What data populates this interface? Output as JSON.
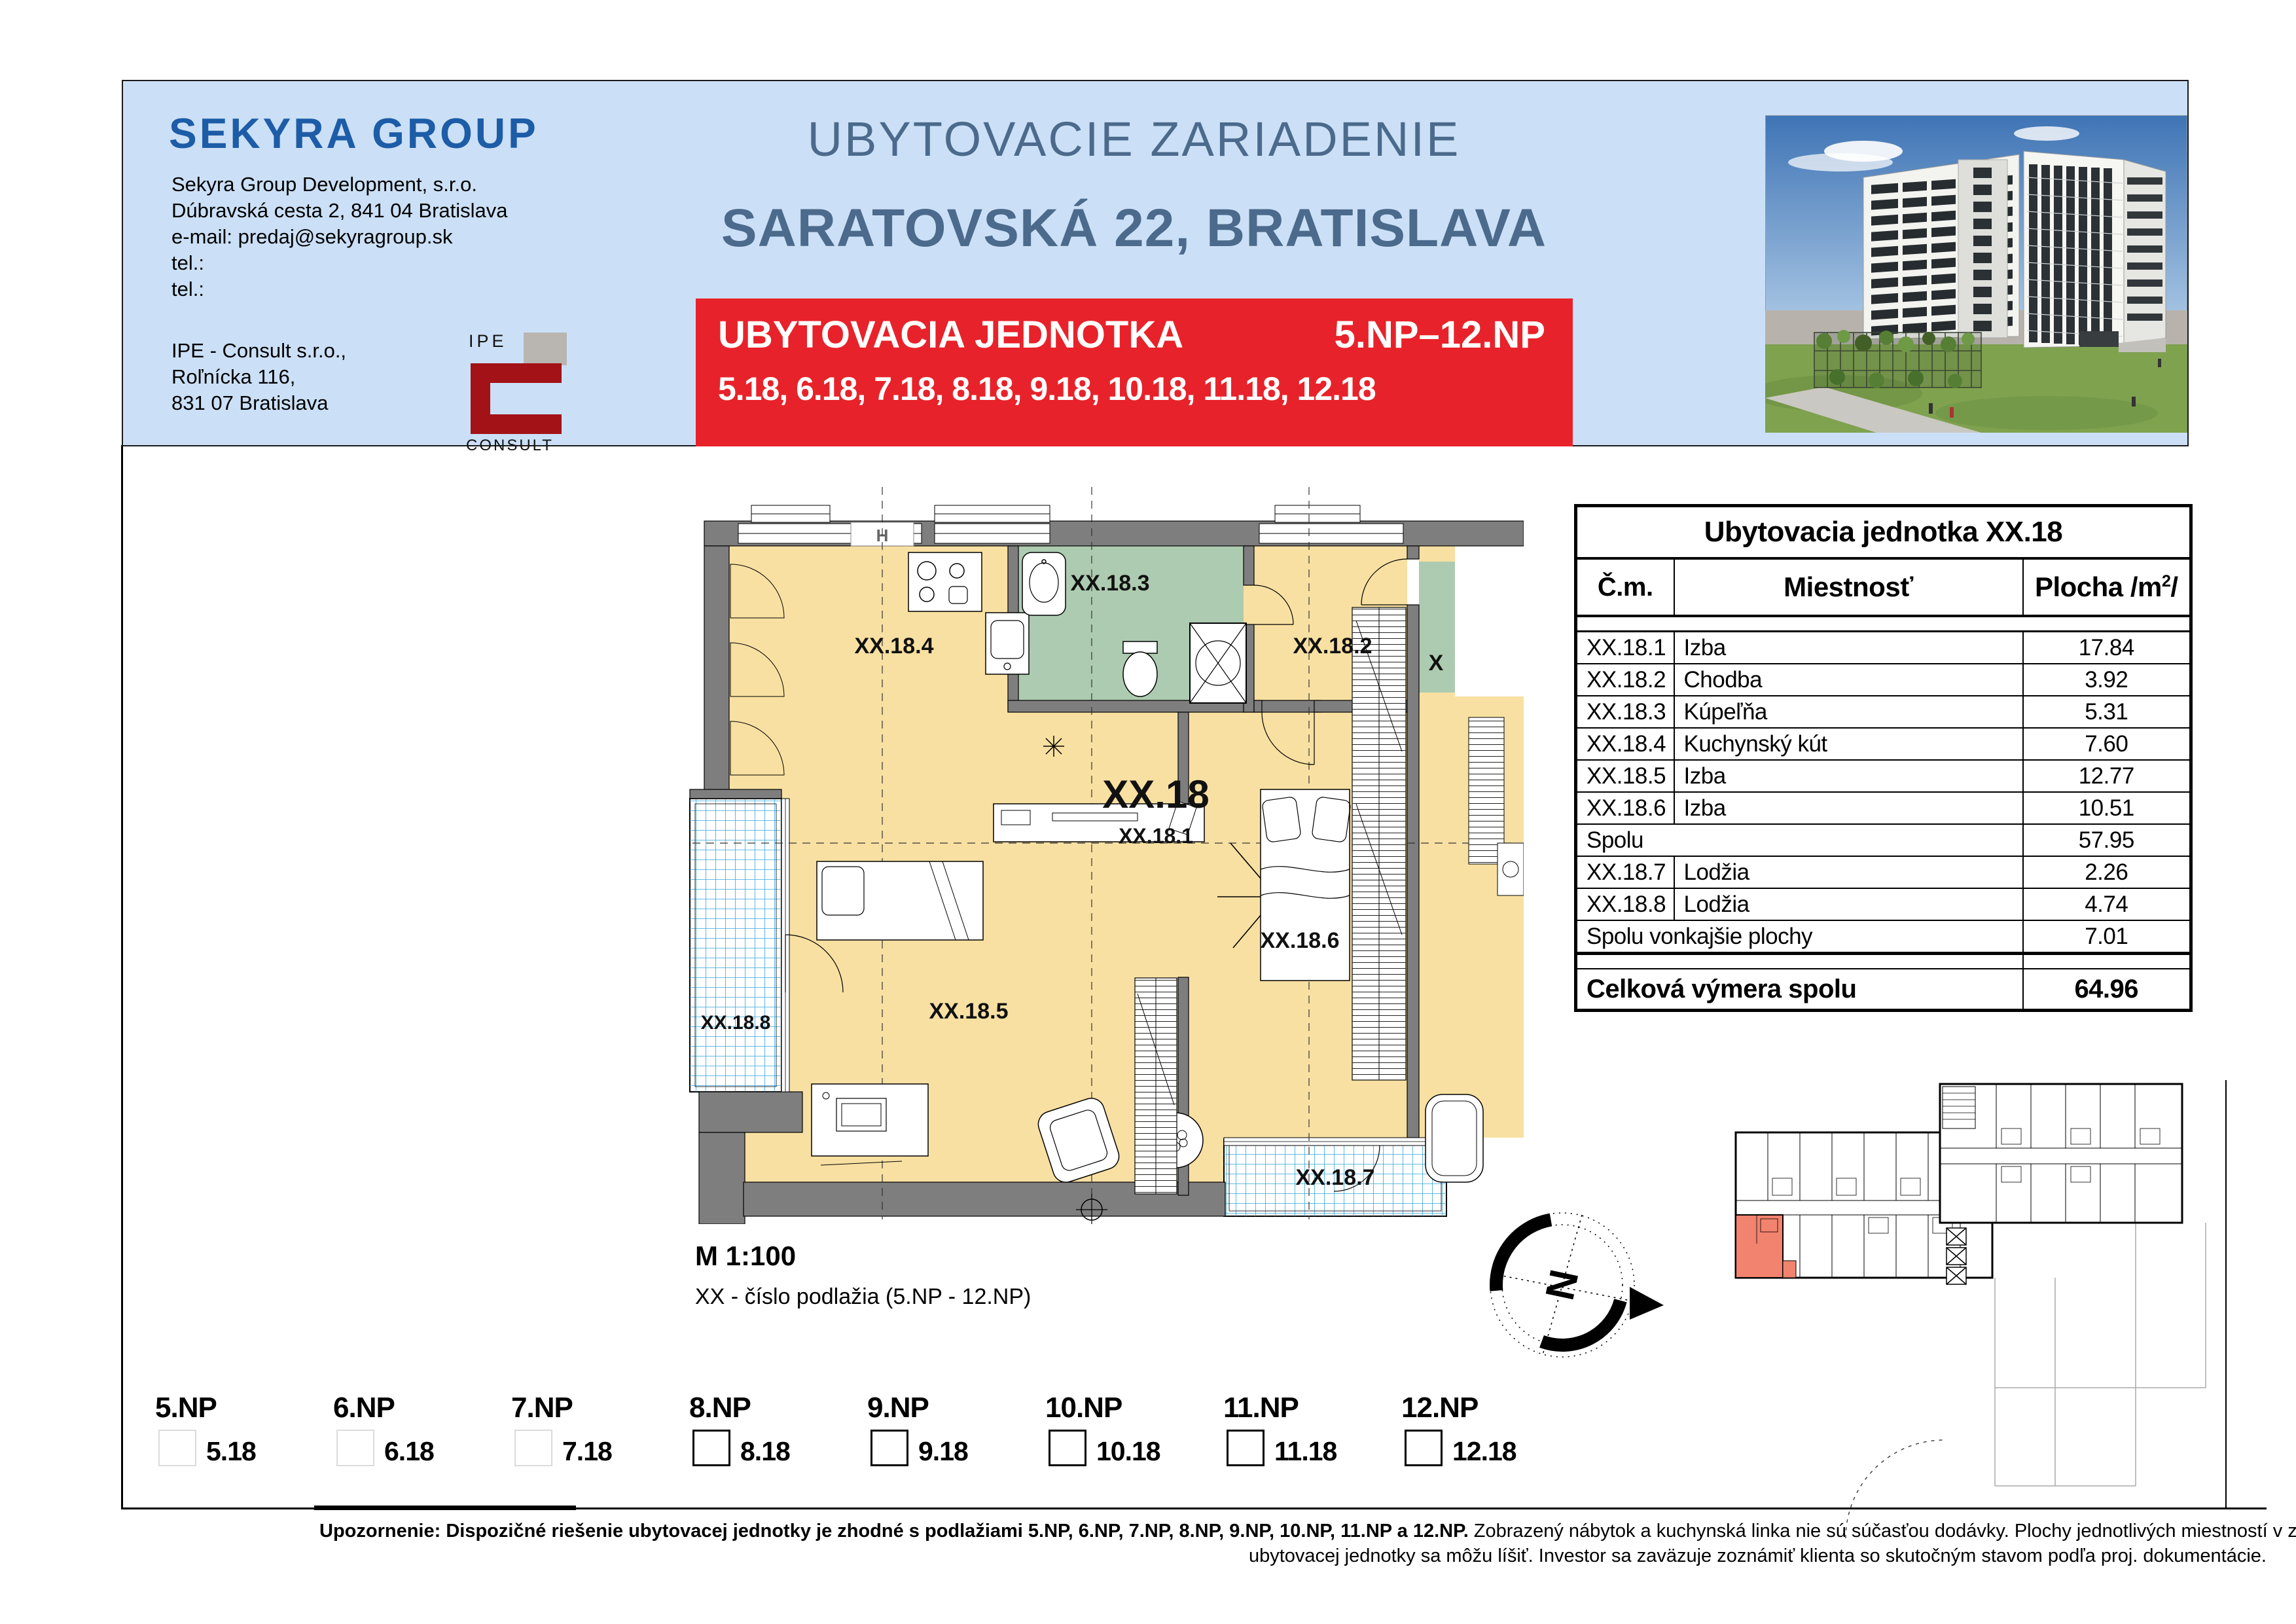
{
  "header": {
    "logo_text": "SEKYRA GROUP",
    "company_line1": "Sekyra Group Development, s.r.o.",
    "company_line2": "Dúbravská cesta 2, 841 04 Bratislava",
    "company_line3": "e-mail: predaj@sekyragroup.sk",
    "company_line4": "tel.:",
    "company_line5": "tel.:",
    "consultant_line1": "IPE - Consult s.r.o.,",
    "consultant_line2": "Roľnícka 116,",
    "consultant_line3": "831 07 Bratislava",
    "ipe_logo_top": "IPE",
    "ipe_logo_bottom": "CONSULT",
    "title_line1": "UBYTOVACIE ZARIADENIE",
    "title_line2": "SARATOVSKÁ 22, BRATISLAVA",
    "banner_label": "UBYTOVACIA JEDNOTKA",
    "banner_floors": "5.NP–12.NP",
    "banner_units": "5.18, 6.18, 7.18, 8.18, 9.18, 10.18, 11.18, 12.18"
  },
  "table": {
    "title": "Ubytovacia jednotka XX.18",
    "headers": {
      "num": "Č.m.",
      "room": "Miestnosť",
      "area_pre": "Plocha /m",
      "area_sup": "2",
      "area_post": "/"
    },
    "rows": [
      {
        "num": "XX.18.1",
        "room": "Izba",
        "area": "17.84"
      },
      {
        "num": "XX.18.2",
        "room": "Chodba",
        "area": "3.92"
      },
      {
        "num": "XX.18.3",
        "room": "Kúpeľňa",
        "area": "5.31"
      },
      {
        "num": "XX.18.4",
        "room": "Kuchynský kút",
        "area": "7.60"
      },
      {
        "num": "XX.18.5",
        "room": "Izba",
        "area": "12.77"
      },
      {
        "num": "XX.18.6",
        "room": "Izba",
        "area": "10.51"
      }
    ],
    "subtotal": {
      "label": "Spolu",
      "area": "57.95"
    },
    "exterior_rows": [
      {
        "num": "XX.18.7",
        "room": "Lodžia",
        "area": "2.26"
      },
      {
        "num": "XX.18.8",
        "room": "Lodžia",
        "area": "4.74"
      }
    ],
    "exterior_subtotal": {
      "label": "Spolu vonkajšie plochy",
      "area": "7.01"
    },
    "total": {
      "label": "Celková výmera spolu",
      "area": "64.96"
    }
  },
  "plan": {
    "labels": {
      "unit": "XX.18",
      "r1": "XX.18.1",
      "r2": "XX.18.2",
      "r3": "XX.18.3",
      "r4": "XX.18.4",
      "r5": "XX.18.5",
      "r6": "XX.18.6",
      "r7": "XX.18.7",
      "r8": "XX.18.8",
      "grid": "H",
      "neighbor": "X"
    },
    "scale": "M 1:100",
    "note": "XX - číslo podlažia (5.NP - 12.NP)"
  },
  "compass": {
    "north": "N"
  },
  "floors": [
    {
      "np": "5.NP",
      "unit": "5.18",
      "box_class": "abs floor-box faint"
    },
    {
      "np": "6.NP",
      "unit": "6.18",
      "box_class": "abs floor-box faint"
    },
    {
      "np": "7.NP",
      "unit": "7.18",
      "box_class": "abs floor-box faint"
    },
    {
      "np": "8.NP",
      "unit": "8.18",
      "box_class": "abs floor-box solid"
    },
    {
      "np": "9.NP",
      "unit": "9.18",
      "box_class": "abs floor-box solid"
    },
    {
      "np": "10.NP",
      "unit": "10.18",
      "box_class": "abs floor-box solid"
    },
    {
      "np": "11.NP",
      "unit": "11.18",
      "box_class": "abs floor-box solid"
    },
    {
      "np": "12.NP",
      "unit": "12.18",
      "box_class": "abs floor-box solid"
    }
  ],
  "footer": {
    "bold": "Upozornenie: Dispozičné riešenie ubytovacej jednotky je zhodné s podlažiami 5.NP, 6.NP, 7.NP, 8.NP, 9.NP, 10.NP, 11.NP a 12.NP.",
    "line1_rest": " Zobrazený nábytok a kuchynská linka nie sú súčasťou dodávky. Plochy jednotlivých miestností v zobrazenej schéme",
    "line2": "ubytovacej jednotky sa môžu líšiť. Investor sa zaväzuje zoznámiť klienta so skutočným stavom podľa proj. dokumentácie."
  },
  "colors": {
    "header_bg": "#cbe0f6",
    "title_blue": "#4b6a8c",
    "logo_blue": "#1d5ca7",
    "banner_red": "#e8222a",
    "plan_yellow": "#f8e0a2",
    "plan_green": "#adcbb0",
    "tile_blue": "#36a6dc",
    "wall_gray": "#7e7e7e",
    "unit_highlight": "#f2836e"
  }
}
